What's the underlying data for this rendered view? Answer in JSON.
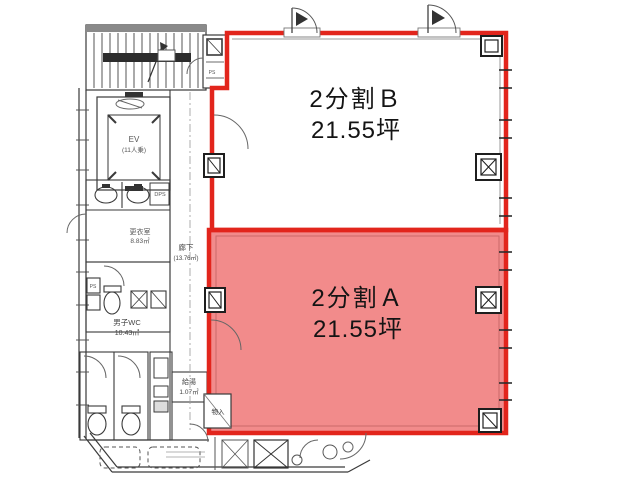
{
  "plan": {
    "title": "floor-plan-2-division",
    "colors": {
      "highlight_fill": "#f28b8b",
      "outline_red": "#e2251c",
      "line_dark": "#333333",
      "line_gray": "#777777"
    },
    "units": {
      "unit_b": {
        "name": "2分割Ｂ",
        "area": "21.55坪",
        "highlighted": false
      },
      "unit_a": {
        "name": "2分割Ａ",
        "area": "21.55坪",
        "highlighted": true
      }
    },
    "rooms": {
      "elevator": {
        "l1": "EV",
        "l2": "(11人乗)"
      },
      "mens_wc": {
        "l1": "男子WC",
        "l2": "10.43㎡"
      },
      "corridor": {
        "l1": "廊下",
        "l2": "(13.76㎡)"
      },
      "kitchenette": {
        "l1": "給湯",
        "l2": "1.07㎡"
      },
      "storage": {
        "label": "物入"
      },
      "changing": {
        "l1": "更衣室",
        "l2": "8.83㎡"
      },
      "ps": {
        "label": "PS"
      },
      "dps": {
        "label": "DPS"
      }
    }
  }
}
